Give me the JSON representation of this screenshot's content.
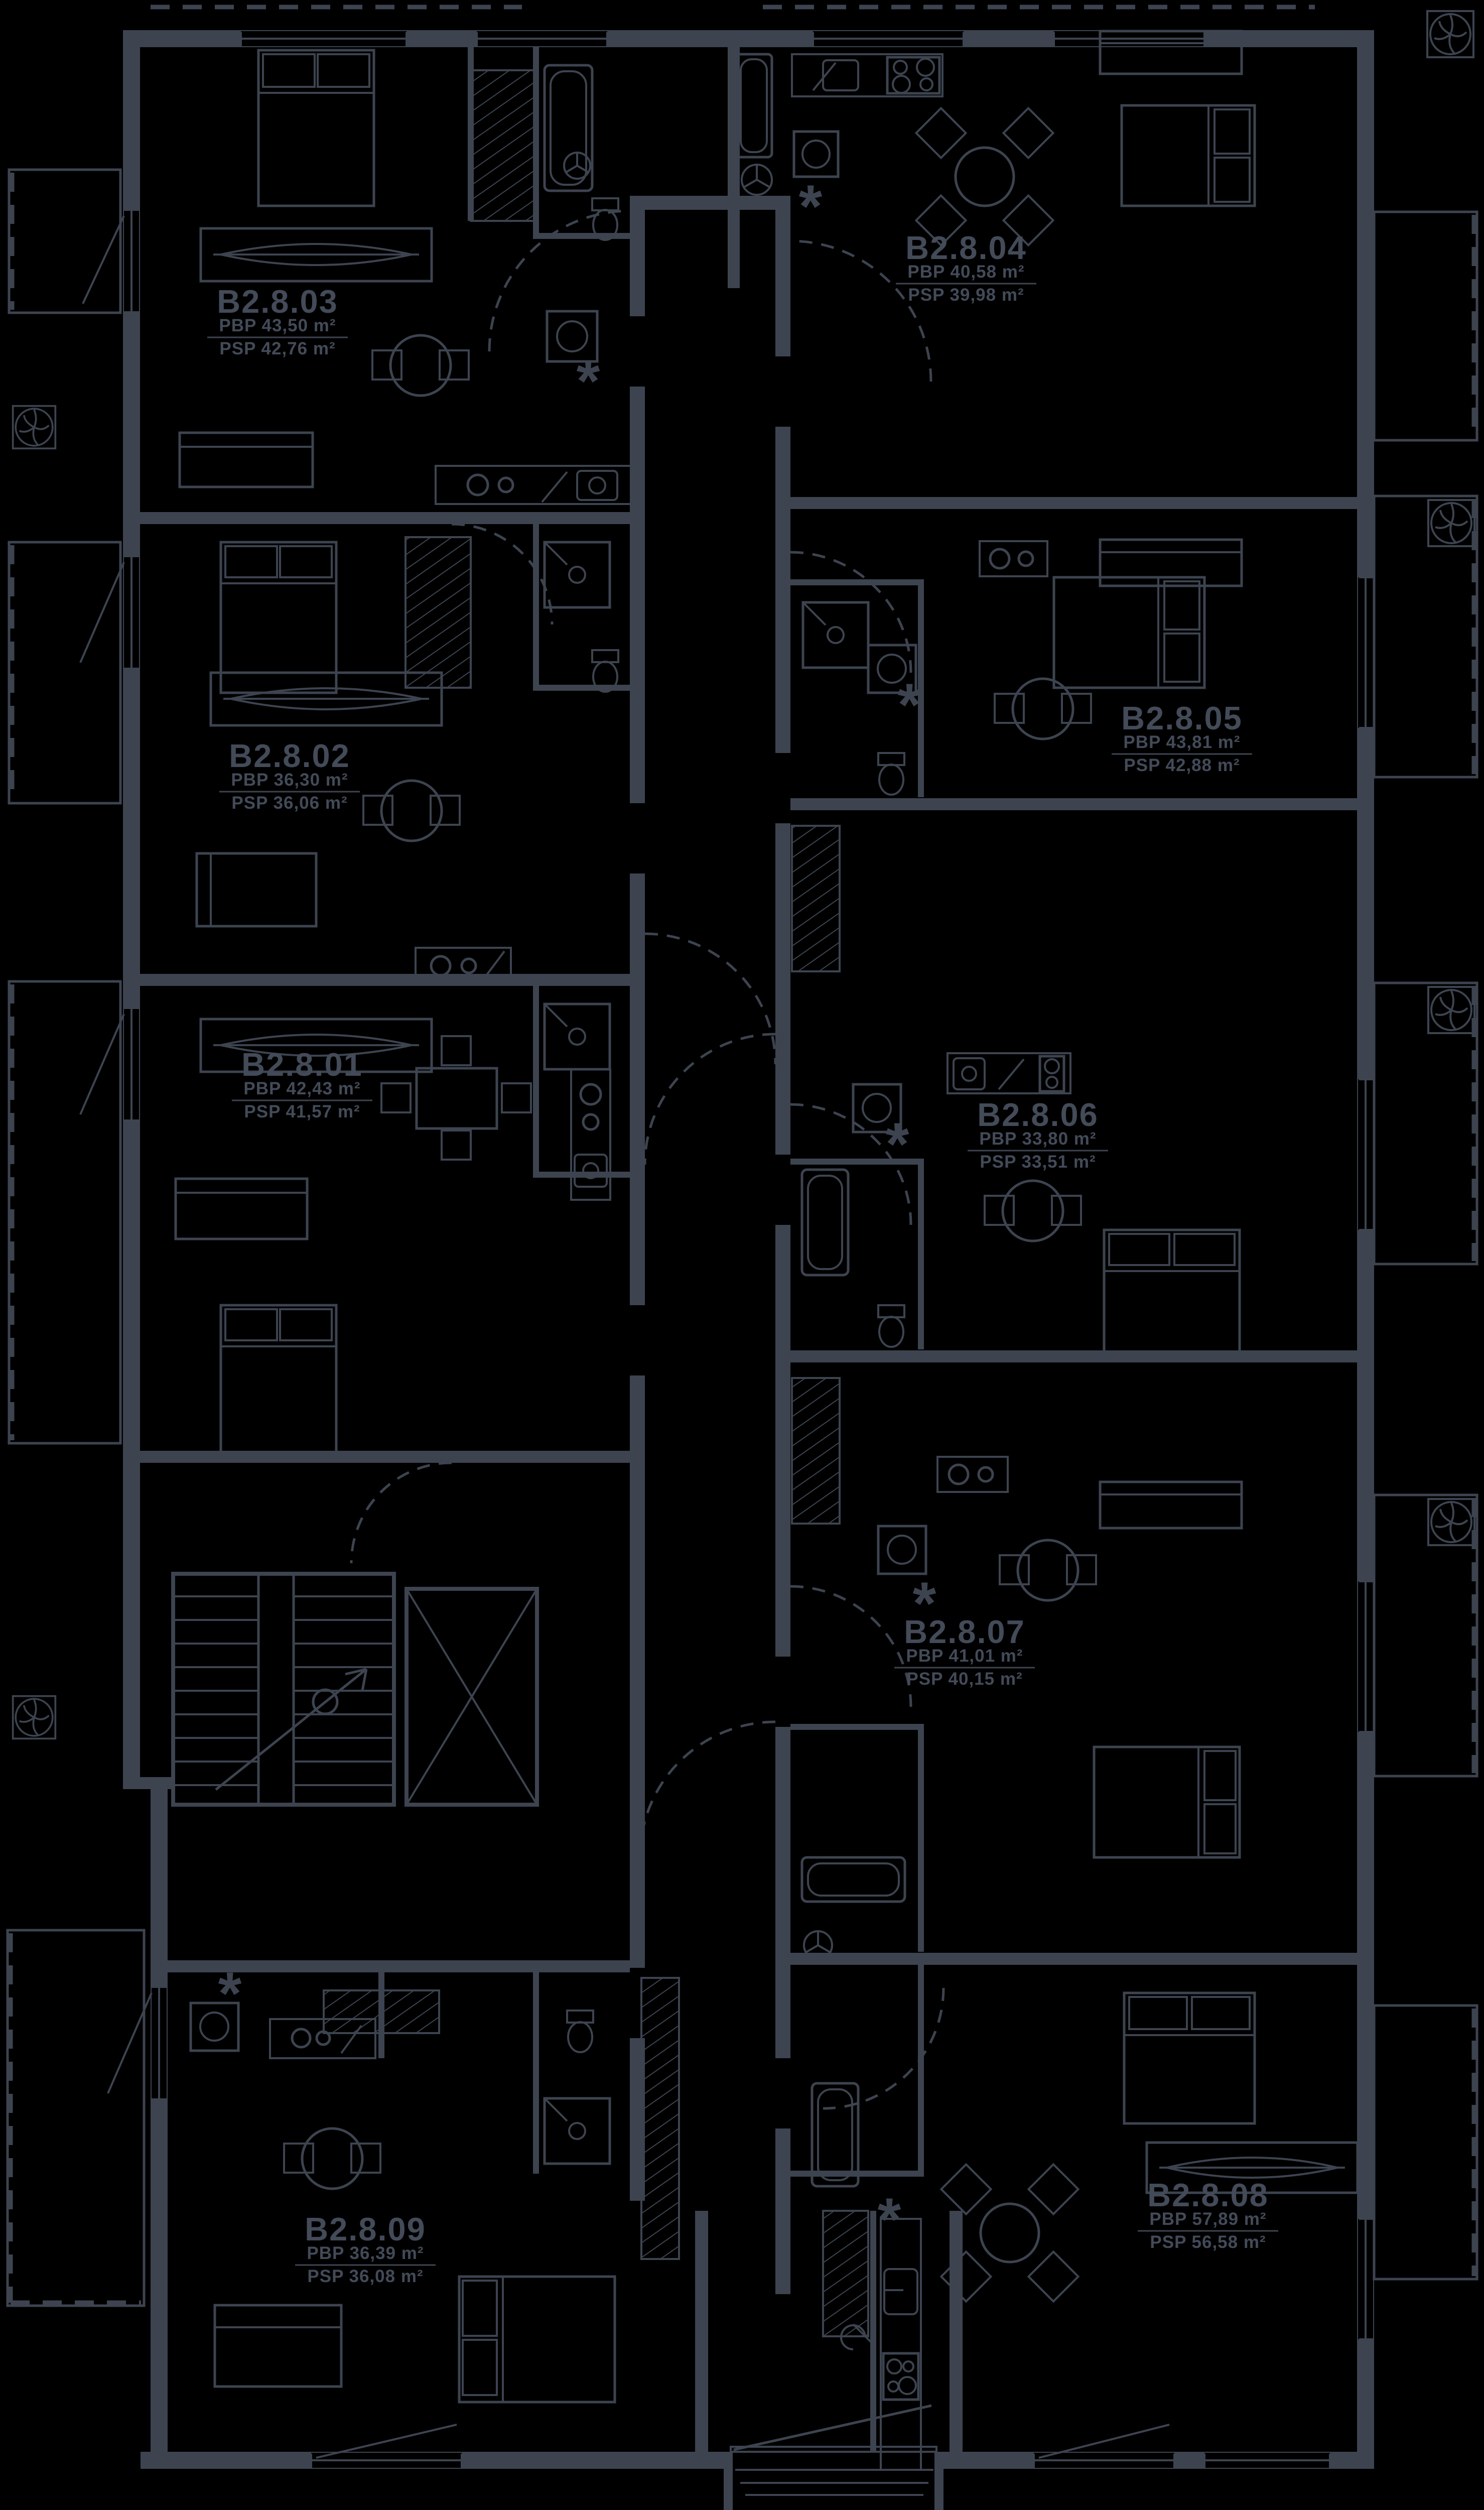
{
  "plan": {
    "colors": {
      "background": "#000000",
      "line": "#3d4450",
      "label_text": "#434a58"
    },
    "apartments": [
      {
        "id": "B2.8.01",
        "pbp": "PBP 42,43 m²",
        "psp": "PSP 41,57 m²"
      },
      {
        "id": "B2.8.02",
        "pbp": "PBP 36,30 m²",
        "psp": "PSP 36,06 m²"
      },
      {
        "id": "B2.8.03",
        "pbp": "PBP 43,50 m²",
        "psp": "PSP 42,76 m²"
      },
      {
        "id": "B2.8.04",
        "pbp": "PBP 40,58 m²",
        "psp": "PSP 39,98 m²"
      },
      {
        "id": "B2.8.05",
        "pbp": "PBP 43,81 m²",
        "psp": "PSP 42,88 m²"
      },
      {
        "id": "B2.8.06",
        "pbp": "PBP 33,80 m²",
        "psp": "PSP 33,51 m²"
      },
      {
        "id": "B2.8.07",
        "pbp": "PBP 41,01 m²",
        "psp": "PSP 40,15 m²"
      },
      {
        "id": "B2.8.08",
        "pbp": "PBP 57,89 m²",
        "psp": "PSP 56,58 m²"
      },
      {
        "id": "B2.8.09",
        "pbp": "PBP 36,39 m²",
        "psp": "PSP 36,08 m²"
      }
    ],
    "symbols": {
      "asterisk": "*"
    }
  }
}
